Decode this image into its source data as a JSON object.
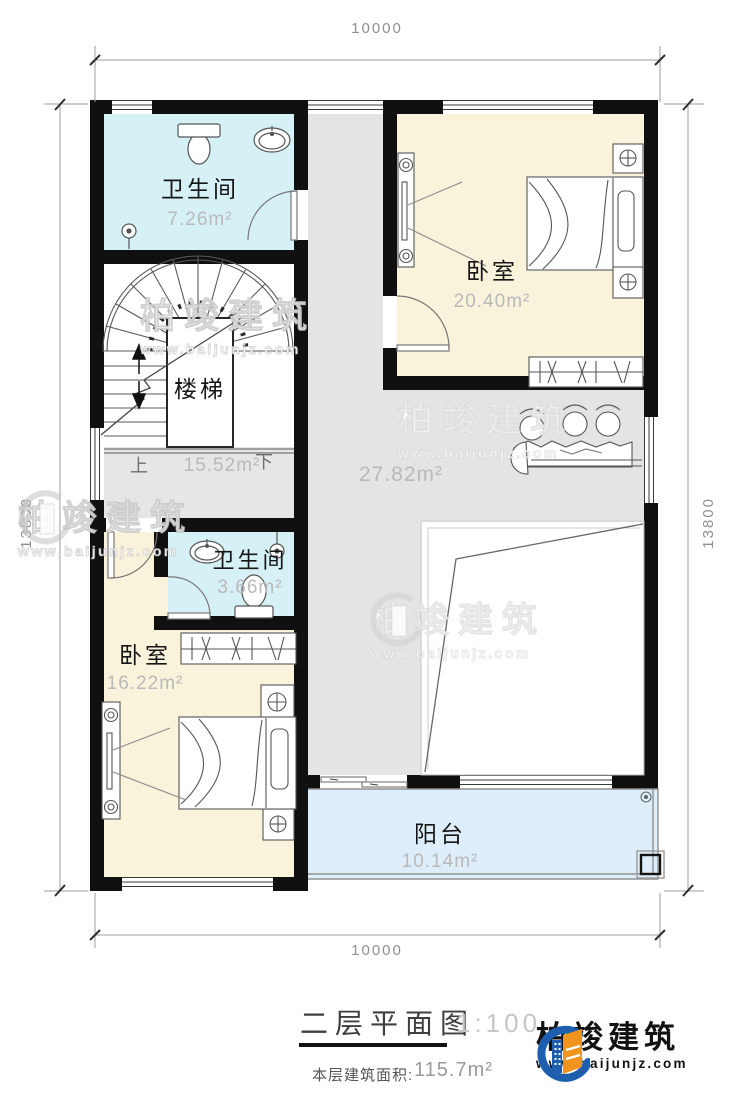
{
  "titleblock": {
    "title": "二层平面图",
    "scale": "1:100",
    "area_label": "本层建筑面积:",
    "area_value": "115.7m²"
  },
  "dimensions": {
    "top": "10000",
    "bottom": "10000",
    "left": "13800",
    "right": "13800"
  },
  "rooms": {
    "bath1": {
      "name": "卫生间",
      "area": "7.26m²"
    },
    "bed1": {
      "name": "卧室",
      "area": "20.40m²"
    },
    "stairs": {
      "name": "楼梯",
      "area": "15.52m²",
      "up": "上",
      "down": "下"
    },
    "hall": {
      "area": "27.82m²"
    },
    "bath2": {
      "name": "卫生间",
      "area": "3.66m²"
    },
    "bed2": {
      "name": "卧室",
      "area": "16.22m²"
    },
    "balcony": {
      "name": "阳台",
      "area": "10.14m²"
    }
  },
  "watermark": {
    "name": "柏竣建筑",
    "url": "www.baijunjz.com"
  },
  "brand": {
    "name": "柏竣建筑",
    "url": "www.baijunjz.com"
  },
  "colors": {
    "wall": "#101010",
    "bathroom_fill": "#d6f1f6",
    "bedroom_fill": "#faf3dc",
    "hall_fill": "#e4e4e4",
    "balcony_fill": "#ddeefa",
    "logo_blue": "#1d5fae",
    "logo_orange": "#f0941d"
  }
}
